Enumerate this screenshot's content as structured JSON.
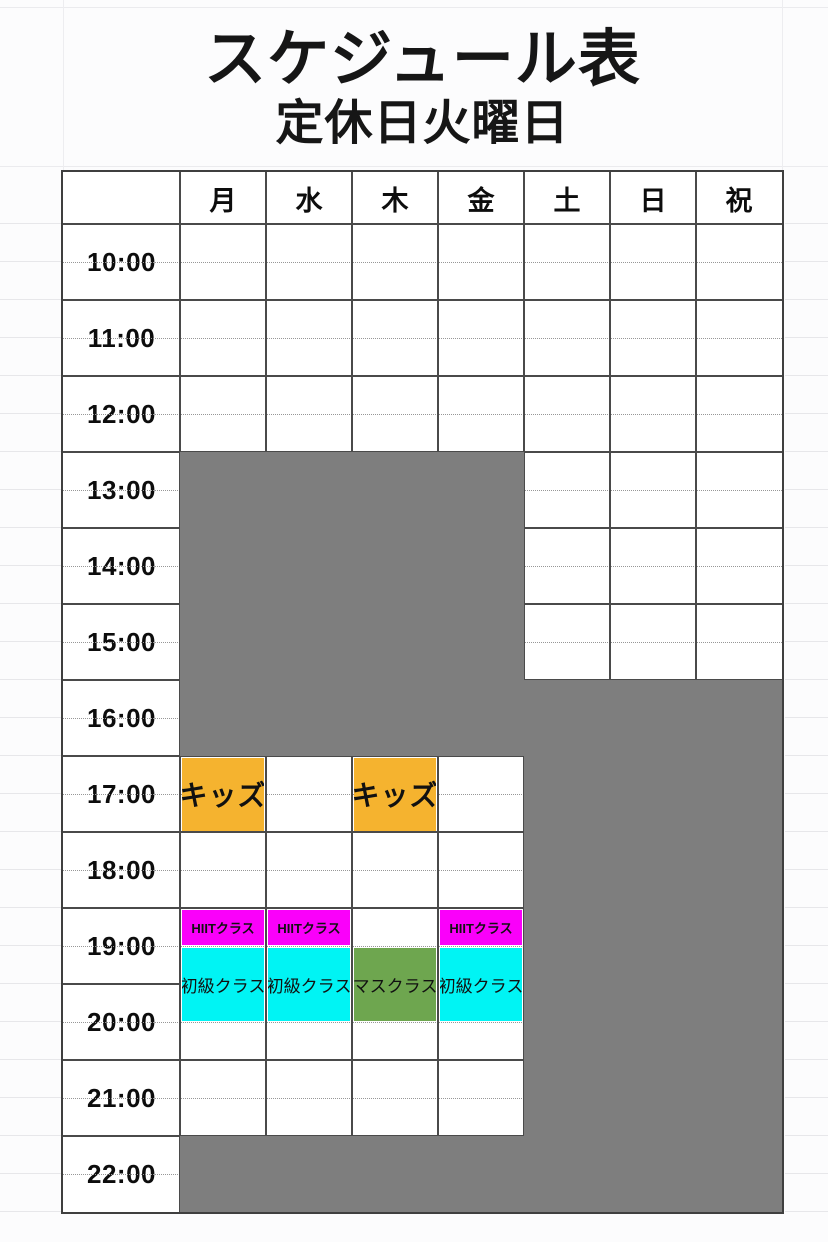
{
  "title": "スケジュール表",
  "subtitle": "定休日火曜日",
  "days": [
    "月",
    "水",
    "木",
    "金",
    "土",
    "日",
    "祝"
  ],
  "times": [
    "10:00",
    "11:00",
    "12:00",
    "13:00",
    "14:00",
    "15:00",
    "16:00",
    "17:00",
    "18:00",
    "19:00",
    "20:00",
    "21:00",
    "22:00"
  ],
  "colors": {
    "closed_gray": "#7e7e7e",
    "kids_orange": "#f5b32f",
    "hiit_magenta": "#fa00fa",
    "beginner_cyan": "#00f4f4",
    "mass_green": "#6ea64f"
  },
  "closed_blocks": [
    {
      "days": "月・水・木・金",
      "rows": "13:00〜16:00",
      "col_start": 0,
      "col_span": 4,
      "half_start": 6,
      "half_span": 8
    },
    {
      "days": "土・日・祝",
      "rows": "16:00〜22:00",
      "col_start": 4,
      "col_span": 3,
      "half_start": 12,
      "half_span": 14
    },
    {
      "days": "月・水・木・金",
      "rows": "22:00",
      "col_start": 0,
      "col_span": 4,
      "half_start": 24,
      "half_span": 2
    }
  ],
  "events": [
    {
      "label": "キッズ",
      "day": "月",
      "col": 0,
      "half_start": 14,
      "half_span": 2,
      "color_key": "kids_orange",
      "style": "ev-kids"
    },
    {
      "label": "キッズ",
      "day": "木",
      "col": 2,
      "half_start": 14,
      "half_span": 2,
      "color_key": "kids_orange",
      "style": "ev-kids"
    },
    {
      "label": "HIITクラス",
      "day": "月",
      "col": 0,
      "half_start": 18,
      "half_span": 1,
      "color_key": "hiit_magenta",
      "style": "ev-hiit"
    },
    {
      "label": "HIITクラス",
      "day": "水",
      "col": 1,
      "half_start": 18,
      "half_span": 1,
      "color_key": "hiit_magenta",
      "style": "ev-hiit"
    },
    {
      "label": "HIITクラス",
      "day": "金",
      "col": 3,
      "half_start": 18,
      "half_span": 1,
      "color_key": "hiit_magenta",
      "style": "ev-hiit"
    },
    {
      "label": "初級クラス",
      "day": "月",
      "col": 0,
      "half_start": 19,
      "half_span": 2,
      "color_key": "beginner_cyan",
      "style": "ev-class"
    },
    {
      "label": "初級クラス",
      "day": "水",
      "col": 1,
      "half_start": 19,
      "half_span": 2,
      "color_key": "beginner_cyan",
      "style": "ev-class"
    },
    {
      "label": "マスクラス",
      "day": "木",
      "col": 2,
      "half_start": 19,
      "half_span": 2,
      "color_key": "mass_green",
      "style": "ev-class"
    },
    {
      "label": "初級クラス",
      "day": "金",
      "col": 3,
      "half_start": 19,
      "half_span": 2,
      "color_key": "beginner_cyan",
      "style": "ev-class"
    }
  ]
}
